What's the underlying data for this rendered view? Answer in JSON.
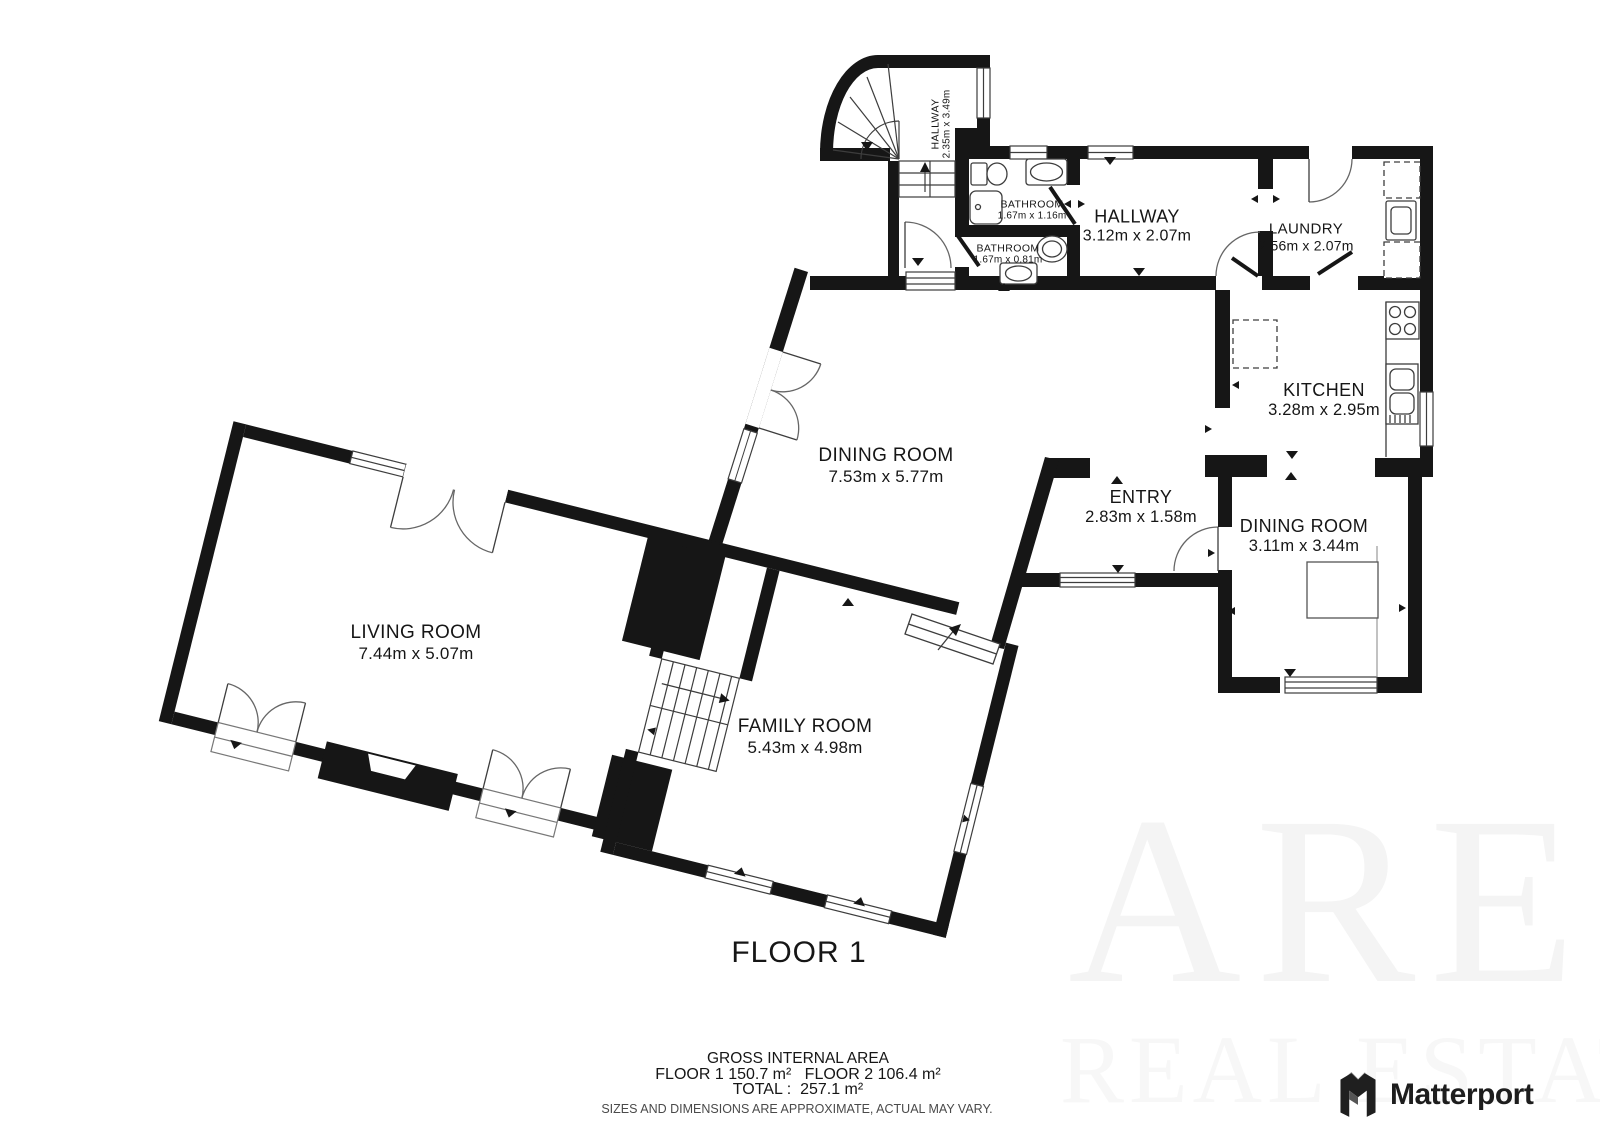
{
  "floor": {
    "title": "FLOOR 1"
  },
  "rooms": [
    {
      "id": "hallway-stairs",
      "name": "HALLWAY",
      "dims": "2.35m x 3.49m"
    },
    {
      "id": "bathroom-1",
      "name": "BATHROOM",
      "dims": "1.67m x 1.16m"
    },
    {
      "id": "bathroom-2",
      "name": "BATHROOM",
      "dims": "1.67m x 0.81m"
    },
    {
      "id": "hallway",
      "name": "HALLWAY",
      "dims": "3.12m x 2.07m"
    },
    {
      "id": "laundry",
      "name": "LAUNDRY",
      "dims": "2.56m x 2.07m"
    },
    {
      "id": "kitchen",
      "name": "KITCHEN",
      "dims": "3.28m x 2.95m"
    },
    {
      "id": "dining-room",
      "name": "DINING ROOM",
      "dims": "7.53m x 5.77m"
    },
    {
      "id": "entry",
      "name": "ENTRY",
      "dims": "2.83m x 1.58m"
    },
    {
      "id": "dining-room-2",
      "name": "DINING ROOM",
      "dims": "3.11m x 3.44m"
    },
    {
      "id": "living-room",
      "name": "LIVING ROOM",
      "dims": "7.44m x 5.07m"
    },
    {
      "id": "family-room",
      "name": "FAMILY ROOM",
      "dims": "5.43m x 4.98m"
    }
  ],
  "footer": {
    "area_heading": "GROSS INTERNAL AREA",
    "floor_areas": "FLOOR 1 150.7 m²   FLOOR 2 106.4 m²",
    "total": "TOTAL :  257.1 m²",
    "disclaimer": "SIZES AND DIMENSIONS ARE APPROXIMATE, ACTUAL MAY VARY."
  },
  "branding": {
    "wordmark": "Matterport"
  },
  "watermark": {
    "line1": "ARE",
    "line2": "REAL ESTATE"
  },
  "colors": {
    "wall": "#161616",
    "fixture": "#3d3d3d",
    "door_arc": "#666666"
  }
}
